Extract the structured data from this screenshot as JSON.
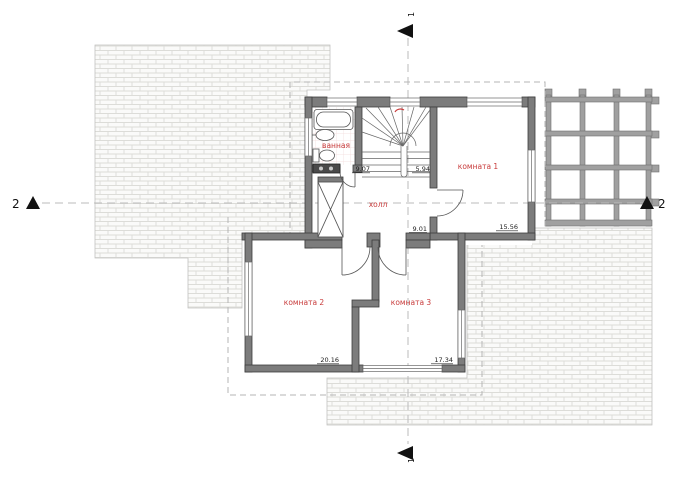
{
  "drawing": {
    "rooms": [
      {
        "id": "bathroom",
        "label": "ванная",
        "area": "9.07"
      },
      {
        "id": "stairs",
        "label": "",
        "area": "5.94"
      },
      {
        "id": "hall",
        "label": "холл",
        "area": "9.01"
      },
      {
        "id": "room1",
        "label": "комната 1",
        "area": "15.56"
      },
      {
        "id": "room2",
        "label": "комната 2",
        "area": "20.16"
      },
      {
        "id": "room3",
        "label": "комната 3",
        "area": "17.34"
      }
    ],
    "section_lines": {
      "vertical_label": "1",
      "horizontal_label": "2"
    },
    "icons": [
      "section-arrow-up",
      "section-arrow-left",
      "bathtub",
      "washbasin",
      "toilet",
      "washing-machine",
      "shaft-x-box",
      "stair-direction-mark"
    ],
    "colors": {
      "wall": "#7c7c7c",
      "wall_edge": "#3d3d3d",
      "room_label": "#c83c3c",
      "dimension": "#222222",
      "brick_line": "#dcdcd8",
      "dash": "#b5b5b5"
    }
  }
}
